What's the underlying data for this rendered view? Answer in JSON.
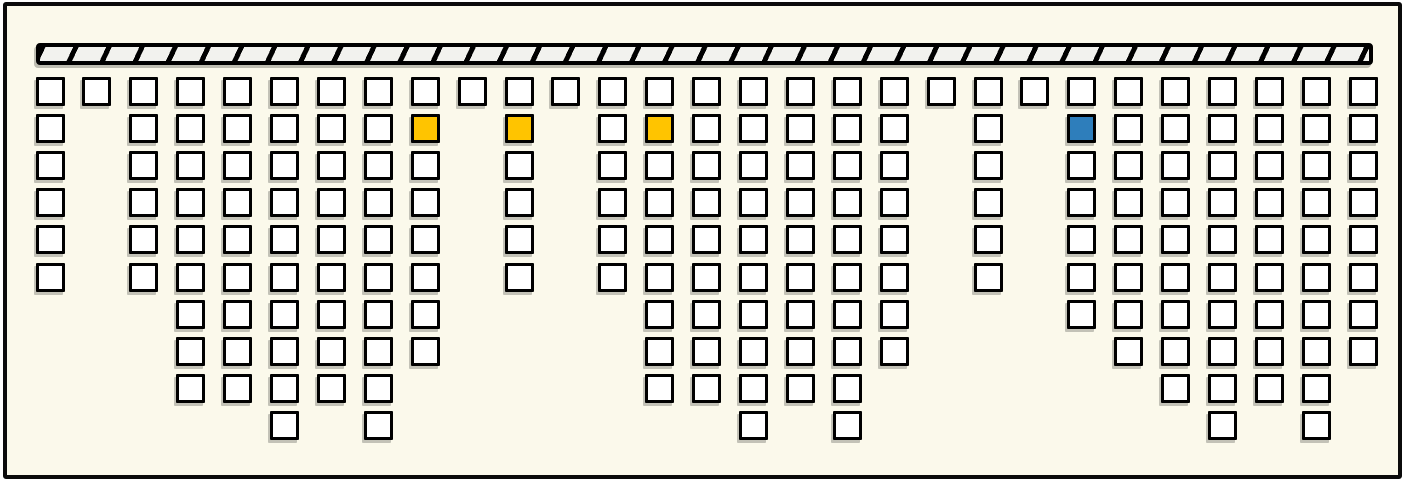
{
  "canvas": {
    "background_color": "#FBF9EB",
    "frame_border_color": "#0b0b0b"
  },
  "ceiling_bar": {
    "fill_color": "#F2F2EE",
    "hatch_color": "#000000",
    "border_color": "#000000"
  },
  "grid": {
    "columns": 29,
    "max_rows": 10,
    "cell_fill": "#FFFFFF",
    "cell_border": "#000000",
    "column_depths": [
      6,
      1,
      6,
      9,
      9,
      10,
      9,
      10,
      8,
      1,
      6,
      1,
      6,
      9,
      9,
      10,
      9,
      10,
      8,
      1,
      6,
      1,
      7,
      8,
      9,
      10,
      9,
      10,
      8
    ],
    "highlighted_cells": [
      {
        "column": 9,
        "row": 2,
        "color": "#FFC400",
        "name": "yellow"
      },
      {
        "column": 11,
        "row": 2,
        "color": "#FFC400",
        "name": "yellow"
      },
      {
        "column": 14,
        "row": 2,
        "color": "#FFC400",
        "name": "yellow"
      },
      {
        "column": 23,
        "row": 2,
        "color": "#2E7EBB",
        "name": "blue"
      }
    ],
    "counts": {
      "total_cells": 206,
      "yellow_cells": 3,
      "blue_cells": 1
    }
  }
}
